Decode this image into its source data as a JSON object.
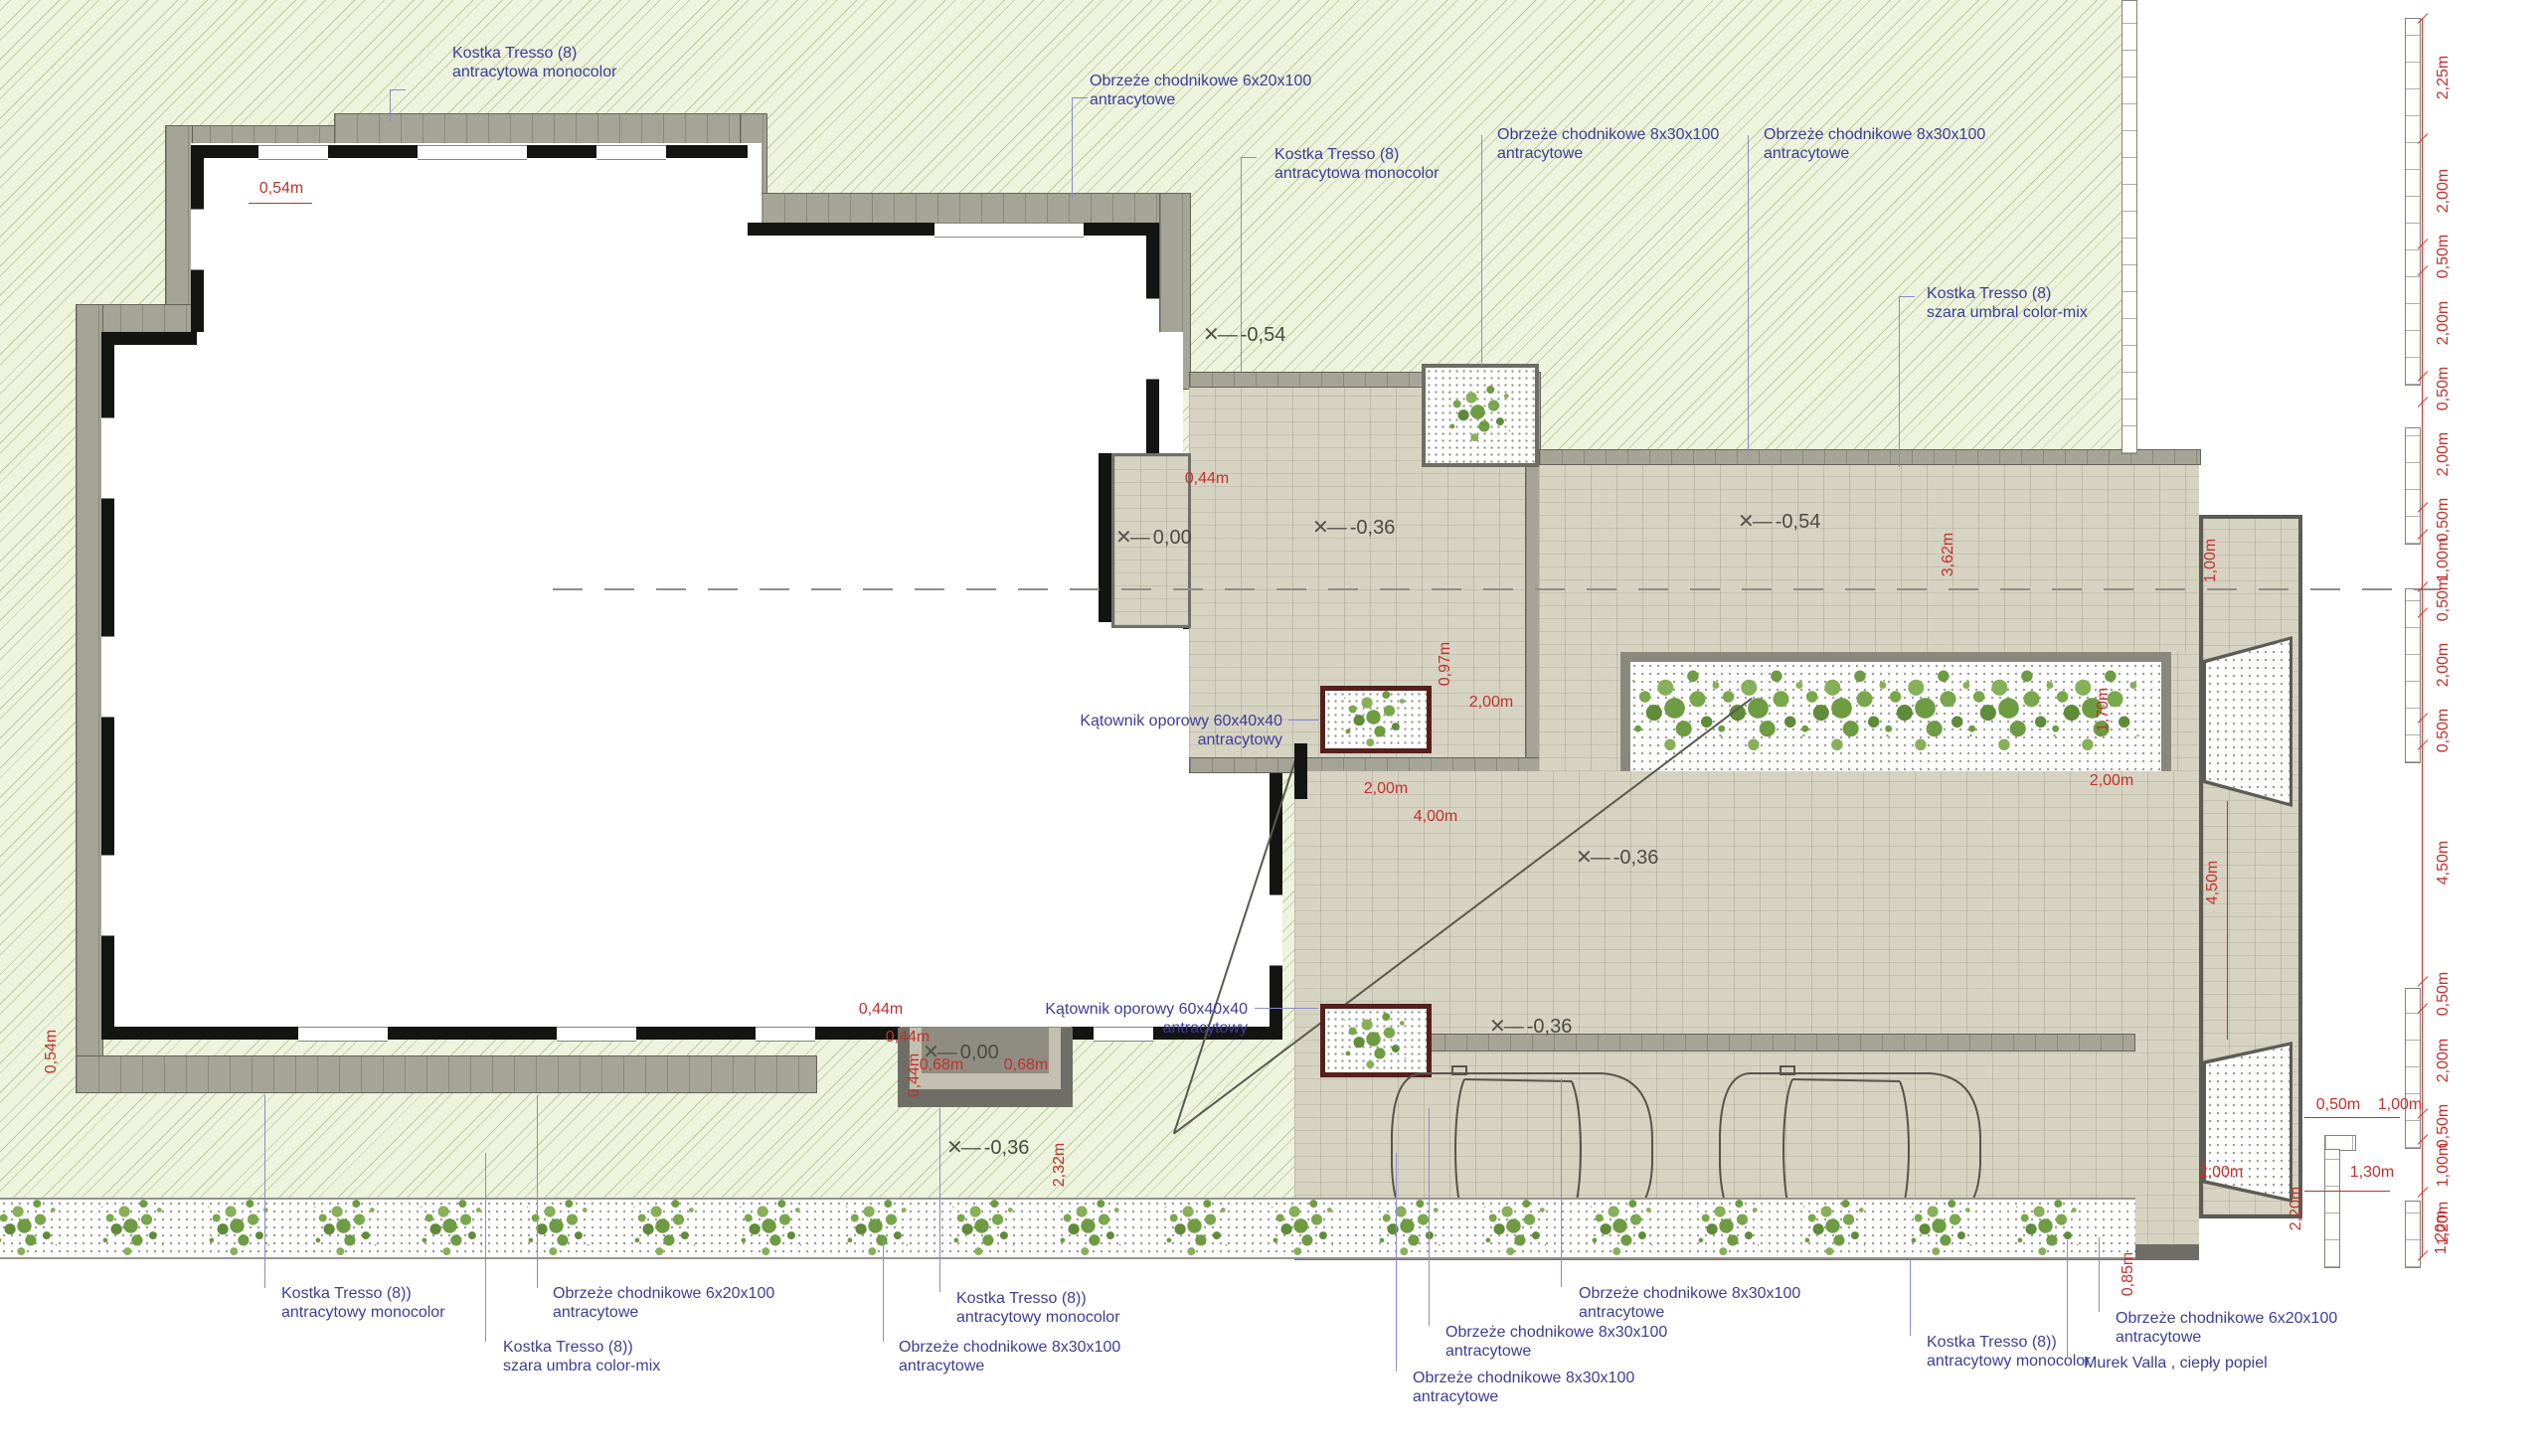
{
  "colors": {
    "label_blue": "#3d3d99",
    "dimension_red": "#c3302b",
    "lawn_green": "#edf3dc",
    "paving_beige": "#d6d3c2",
    "band_gray": "#a6a497",
    "planter_maroon": "#551f1c"
  },
  "materials": [
    {
      "line1": "Kostka Tresso (8)",
      "line2": "antracytowa monocolor"
    },
    {
      "line1": "Obrzeże chodnikowe 6x20x100",
      "line2": "antracytowe"
    },
    {
      "line1": "Kostka Tresso (8)",
      "line2": "antracytowa monocolor"
    },
    {
      "line1": "Obrzeże chodnikowe 8x30x100",
      "line2": "antracytowe"
    },
    {
      "line1": "Obrzeże chodnikowe 8x30x100",
      "line2": "antracytowe"
    },
    {
      "line1": "Kostka Tresso (8)",
      "line2": "szara umbral color-mix"
    },
    {
      "line1": "Kątownik oporowy 60x40x40",
      "line2": "antracytowy"
    },
    {
      "line1": "Kątownik oporowy 60x40x40",
      "line2": "antracytowy"
    },
    {
      "line1": "Kostka Tresso (8))",
      "line2": "antracytowy monocolor"
    },
    {
      "line1": "Obrzeże chodnikowe 6x20x100",
      "line2": "antracytowe"
    },
    {
      "line1": "Kostka Tresso (8))",
      "line2": "szara umbra color-mix"
    },
    {
      "line1": "Kostka Tresso (8))",
      "line2": "antracytowy monocolor"
    },
    {
      "line1": "Obrzeże chodnikowe 8x30x100",
      "line2": "antracytowe"
    },
    {
      "line1": "Obrzeże chodnikowe 8x30x100",
      "line2": "antracytowe"
    },
    {
      "line1": "Obrzeże chodnikowe 8x30x100",
      "line2": "antracytowe"
    },
    {
      "line1": "Obrzeże chodnikowe 8x30x100",
      "line2": "antracytowe"
    },
    {
      "line1": "Kostka Tresso (8))",
      "line2": "antracytowy monocolor"
    },
    {
      "line1": "Obrzeże chodnikowe 6x20x100",
      "line2": "antracytowe"
    },
    {
      "line1": "Murek Valla , ciepły popiel",
      "line2": ""
    }
  ],
  "levels": [
    "-0,54",
    "0,00",
    "-0,36",
    "-0,54",
    "-0,36",
    "0,00",
    "-0,36",
    "-0,36"
  ],
  "dims": [
    "0,54m",
    "0,54m",
    "0,44m",
    "0,44m",
    "0,68m",
    "0,68m",
    "0,44m",
    "2,32m",
    "0,44m",
    "0,97m",
    "2,00m",
    "2,00m",
    "4,00m",
    "3,62m",
    "1,00m",
    "1,70m",
    "2,00m",
    "4,50m",
    "2,00m",
    "0,85m",
    "0,50m",
    "1,00m",
    "1,30m",
    "2,20m",
    "1,20m"
  ],
  "chain": [
    "2,25m",
    "2,00m",
    "0,50m",
    "2,00m",
    "0,50m",
    "2,00m",
    "0,50m",
    "1,00m",
    "0,50m",
    "2,00m",
    "0,50m",
    "4,50m",
    "0,50m",
    "2,00m",
    "0,50m",
    "1,00m",
    "1,20m"
  ]
}
